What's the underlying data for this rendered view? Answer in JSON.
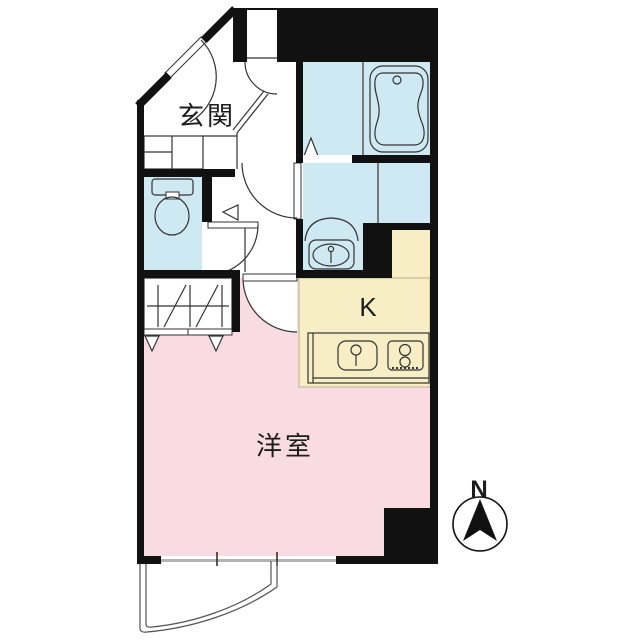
{
  "plan": {
    "type": "apartment-floor-plan",
    "rooms": {
      "entrance": {
        "label": "玄関"
      },
      "western_room": {
        "label": "洋室"
      },
      "kitchen": {
        "label": "K"
      },
      "toilet": {
        "label": ""
      },
      "bathroom": {
        "label": ""
      },
      "washroom": {
        "label": ""
      },
      "closet": {
        "label": ""
      },
      "balcony": {
        "label": ""
      }
    },
    "compass": {
      "label": "N"
    }
  },
  "colors": {
    "wall": "#111111",
    "wet_area": "#cfe9f2",
    "bedroom": "#f9dce3",
    "kitchen": "#f8eec5",
    "outline": "#333333",
    "window_glass": "#b3b3b3"
  }
}
